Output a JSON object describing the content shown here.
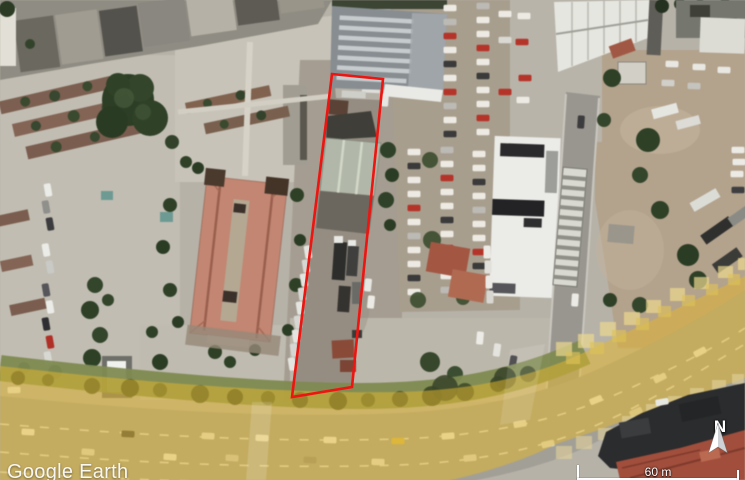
{
  "app": {
    "title": "Google Earth"
  },
  "watermark": {
    "text": "Google Earth"
  },
  "compass": {
    "label": "N",
    "icon": "north-arrow-icon"
  },
  "scale_bar": {
    "label": "60 m"
  },
  "annotation": {
    "parcel_outline": {
      "color": "#ee1410",
      "stroke_width": 2.6,
      "points": "332,74 383,79 352,387 292,397"
    }
  },
  "map": {
    "type": "satellite",
    "highlighted_road": {
      "color": "#e3b62c",
      "opacity": 0.52
    }
  }
}
